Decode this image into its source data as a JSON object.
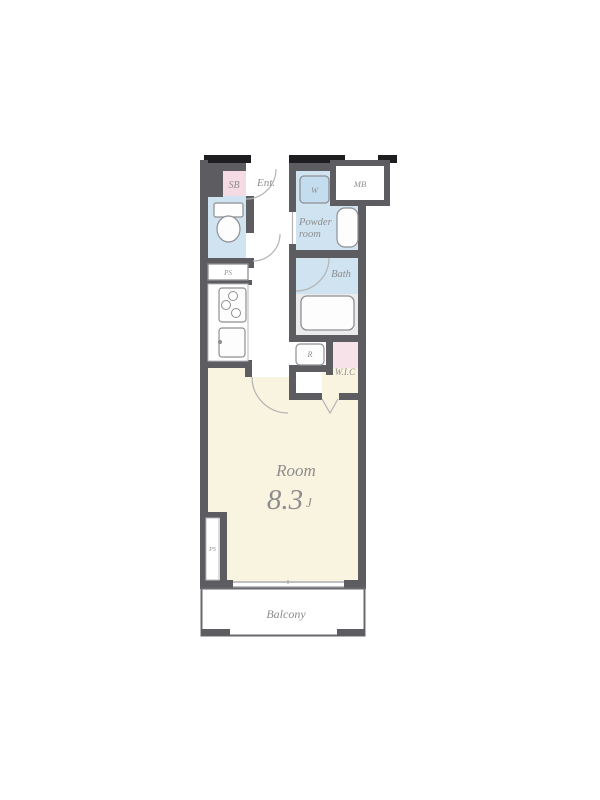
{
  "floorplan": {
    "labels": {
      "shoe_box": "SB",
      "entrance": "Ent.",
      "washer": "W",
      "meter_box": "MB",
      "powder_room_line1": "Powder",
      "powder_room_line2": "room",
      "pipe_space_top": "PS",
      "bath": "Bath",
      "refrigerator": "R",
      "walk_in_closet": "W.I.C",
      "room_name": "Room",
      "room_size_value": "8.3",
      "room_size_unit": "J",
      "balcony": "Balcony",
      "pipe_space_bottom": "PS"
    },
    "colors": {
      "wall": "#5d5d61",
      "exterior_tick": "#1e1e20",
      "wet_area_blue": "#cfe3f1",
      "washer_blue": "#c3ddef",
      "washer_stroke": "#82a7c4",
      "shoe_box_pink": "#f5dce4",
      "closet_pink": "#f8e2ea",
      "room_cream": "#f9f4df",
      "bath_floor_gray": "#ebebeb",
      "fixture_fill": "#fdfdfd",
      "fixture_stroke": "#8f8f93",
      "light_line": "#b3b3b6",
      "balcony_outline": "#6a6a6e",
      "label_gray": "#8d8d8d"
    }
  }
}
